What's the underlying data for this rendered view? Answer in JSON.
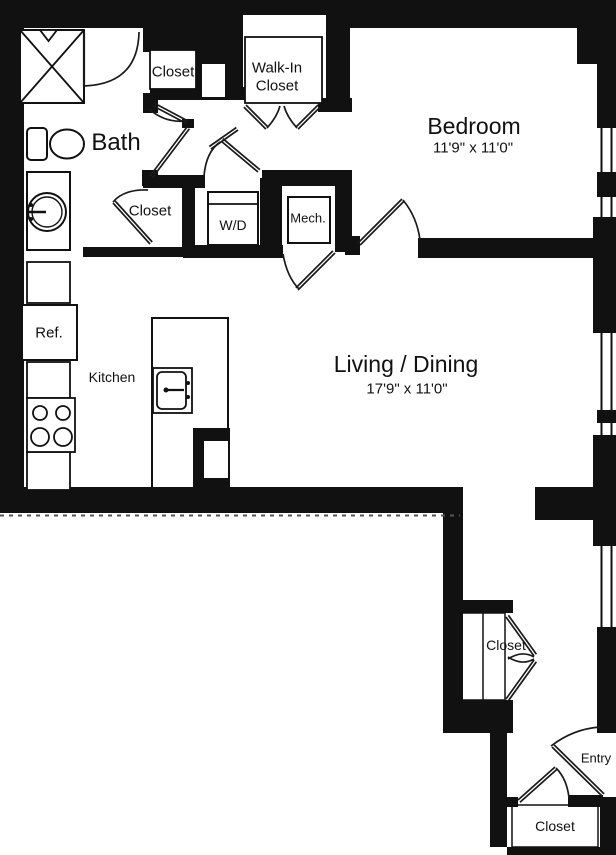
{
  "title": "One-bedroom apartment floor plan",
  "colors": {
    "wall": "#111111",
    "background": "#ffffff",
    "line": "#1a1a1a"
  },
  "rooms": {
    "bedroom": {
      "label": "Bedroom",
      "dimensions": "11'9\" x 11'0\""
    },
    "living_dining": {
      "label": "Living / Dining",
      "dimensions": "17'9\" x 11'0\""
    },
    "bath": {
      "label": "Bath"
    },
    "kitchen": {
      "label": "Kitchen"
    },
    "entry": {
      "label": "Entry"
    },
    "walk_in_closet": {
      "label_line1": "Walk-In",
      "label_line2": "Closet"
    },
    "closet_upper": {
      "label": "Closet"
    },
    "closet_bath": {
      "label": "Closet"
    },
    "closet_hallway": {
      "label": "Closet"
    },
    "closet_entry": {
      "label": "Closet"
    }
  },
  "fixtures": {
    "washer_dryer": {
      "label": "W/D"
    },
    "mechanical": {
      "label": "Mech."
    },
    "refrigerator": {
      "label": "Ref."
    }
  }
}
